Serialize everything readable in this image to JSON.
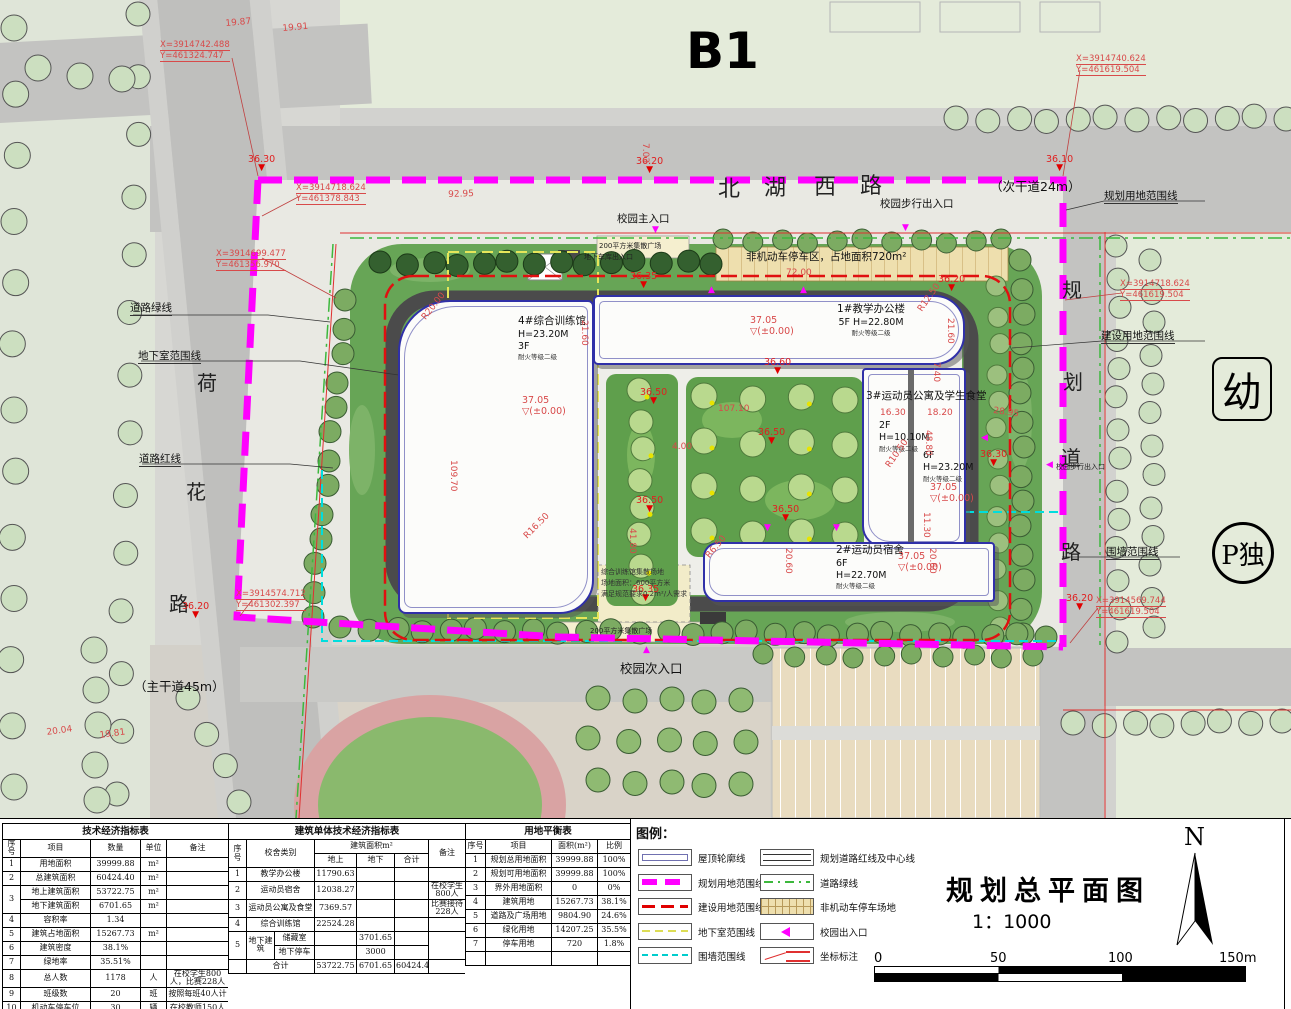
{
  "plan": {
    "zone_label": "B1",
    "markers": {
      "kindergarten": "幼",
      "parking_badge": "P独"
    },
    "buildings": {
      "b4": {
        "name": "4#综合训练馆",
        "height": "H=23.20M",
        "floors": "3F",
        "fire": "耐火等级二级"
      },
      "b1": {
        "name": "1#教学办公楼",
        "line2": "5F  H=22.80M",
        "fire": "耐火等级二级"
      },
      "b3": {
        "name": "3#运动员公寓及学生食堂",
        "west_floors": "2F",
        "west_height": "H=10.10M",
        "west_fire": "耐火等级二级",
        "east_floors": "6F",
        "east_height": "H=23.20M",
        "east_fire": "耐火等级二级"
      },
      "b2": {
        "name": "2#运动员宿舍",
        "floors": "6F",
        "height": "H=22.70M",
        "fire": "耐火等级二级"
      }
    },
    "annotations": [
      {
        "cls": "zone",
        "x": 686,
        "y": 22,
        "t": "B1"
      },
      {
        "cls": "roadname",
        "x": 718,
        "y": 171,
        "t": "北"
      },
      {
        "cls": "roadname",
        "x": 764,
        "y": 170,
        "t": "湖"
      },
      {
        "cls": "roadname",
        "x": 814,
        "y": 169,
        "t": "西"
      },
      {
        "cls": "roadname",
        "x": 860,
        "y": 168,
        "t": "路"
      },
      {
        "cls": "roadchar",
        "x": 197,
        "y": 367,
        "t": "荷"
      },
      {
        "cls": "roadchar",
        "x": 186,
        "y": 476,
        "t": "花"
      },
      {
        "cls": "roadchar",
        "x": 169,
        "y": 588,
        "t": "路"
      },
      {
        "cls": "roadchar",
        "x": 1062,
        "y": 274,
        "t": "规"
      },
      {
        "cls": "roadchar",
        "x": 1063,
        "y": 366,
        "t": "划"
      },
      {
        "cls": "roadchar",
        "x": 1061,
        "y": 442,
        "t": "道"
      },
      {
        "cls": "roadchar",
        "x": 1061,
        "y": 536,
        "t": "路"
      },
      {
        "cls": "lblM",
        "x": 990,
        "y": 176,
        "t": "（次干道24m）"
      },
      {
        "cls": "lblM",
        "x": 134,
        "y": 676,
        "t": "（主干道45m）"
      },
      {
        "cls": "coord",
        "x": 160,
        "y": 40,
        "lines": [
          "X=3914742.488",
          "Y=461324.747"
        ]
      },
      {
        "cls": "coord",
        "x": 296,
        "y": 183,
        "lines": [
          "X=3914718.624",
          "Y=461378.843"
        ]
      },
      {
        "cls": "coord",
        "x": 216,
        "y": 249,
        "lines": [
          "X=3914699.477",
          "Y=461356.970"
        ]
      },
      {
        "cls": "coord",
        "x": 1076,
        "y": 54,
        "lines": [
          "X=3914740.624",
          "Y=461619.504"
        ]
      },
      {
        "cls": "coord",
        "x": 1120,
        "y": 279,
        "lines": [
          "X=3914718.624",
          "Y=461619.504"
        ]
      },
      {
        "cls": "coord",
        "x": 1096,
        "y": 596,
        "lines": [
          "X=3914569.744",
          "Y=461619.504"
        ]
      },
      {
        "cls": "coord",
        "x": 236,
        "y": 589,
        "lines": [
          "X=3914574.712",
          "Y=461302.397"
        ]
      },
      {
        "cls": "elev",
        "x": 248,
        "y": 155,
        "t": "36.30"
      },
      {
        "cls": "elev",
        "x": 636,
        "y": 157,
        "t": "36.20"
      },
      {
        "cls": "elev",
        "x": 1046,
        "y": 155,
        "t": "36.10"
      },
      {
        "cls": "elev",
        "x": 630,
        "y": 272,
        "t": "36.35"
      },
      {
        "cls": "elev",
        "x": 938,
        "y": 275,
        "t": "36.20"
      },
      {
        "cls": "elev",
        "x": 764,
        "y": 358,
        "t": "36.60"
      },
      {
        "cls": "elev",
        "x": 640,
        "y": 388,
        "t": "36.50"
      },
      {
        "cls": "elev",
        "x": 758,
        "y": 428,
        "t": "36.50"
      },
      {
        "cls": "elev",
        "x": 636,
        "y": 496,
        "t": "36.50"
      },
      {
        "cls": "elev",
        "x": 980,
        "y": 450,
        "t": "36.30"
      },
      {
        "cls": "elev",
        "x": 772,
        "y": 505,
        "t": "36.50"
      },
      {
        "cls": "elev",
        "x": 632,
        "y": 585,
        "t": "36.35"
      },
      {
        "cls": "elev",
        "x": 182,
        "y": 602,
        "t": "36.20"
      },
      {
        "cls": "elev",
        "x": 1066,
        "y": 594,
        "t": "36.20"
      },
      {
        "cls": "spot",
        "x": 522,
        "y": 396,
        "lines": [
          "37.05",
          "(±0.00)"
        ]
      },
      {
        "cls": "spot",
        "x": 750,
        "y": 316,
        "lines": [
          "37.05",
          "(±0.00)"
        ]
      },
      {
        "cls": "spot",
        "x": 930,
        "y": 483,
        "lines": [
          "37.05",
          "(±0.00)"
        ]
      },
      {
        "cls": "spot",
        "x": 898,
        "y": 552,
        "lines": [
          "37.05",
          "(±0.00)"
        ]
      },
      {
        "cls": "dim",
        "x": 225,
        "y": 19,
        "t": "19.87",
        "rot": -5
      },
      {
        "cls": "dim",
        "x": 282,
        "y": 24,
        "t": "19.91",
        "rot": -5
      },
      {
        "cls": "dim",
        "x": 448,
        "y": 190,
        "t": "92.95",
        "rot": -2
      },
      {
        "cls": "dim",
        "x": 650,
        "y": 143,
        "t": "7.03",
        "rot": 90
      },
      {
        "cls": "dim",
        "x": 786,
        "y": 268,
        "t": "72.00"
      },
      {
        "cls": "dim",
        "x": 458,
        "y": 460,
        "t": "109.70",
        "rot": 90
      },
      {
        "cls": "dim",
        "x": 589,
        "y": 320,
        "t": "21.60",
        "rot": 90
      },
      {
        "cls": "dim",
        "x": 955,
        "y": 318,
        "t": "21.60",
        "rot": 90
      },
      {
        "cls": "dim",
        "x": 941,
        "y": 362,
        "t": "7.40",
        "rot": 90
      },
      {
        "cls": "dim",
        "x": 880,
        "y": 408,
        "t": "16.30"
      },
      {
        "cls": "dim",
        "x": 927,
        "y": 408,
        "t": "18.20"
      },
      {
        "cls": "dim",
        "x": 994,
        "y": 406,
        "t": "28.95",
        "rot": 8
      },
      {
        "cls": "dim",
        "x": 933,
        "y": 430,
        "t": "48.80",
        "rot": 90
      },
      {
        "cls": "dim",
        "x": 718,
        "y": 404,
        "t": "107.10"
      },
      {
        "cls": "dim",
        "x": 672,
        "y": 442,
        "t": "4.00"
      },
      {
        "cls": "dim",
        "x": 637,
        "y": 528,
        "t": "41.80",
        "rot": 90
      },
      {
        "cls": "dim",
        "x": 793,
        "y": 548,
        "t": "20.60",
        "rot": 90
      },
      {
        "cls": "dim",
        "x": 937,
        "y": 548,
        "t": "20.60",
        "rot": 90
      },
      {
        "cls": "dim",
        "x": 931,
        "y": 512,
        "t": "11.30",
        "rot": 90
      },
      {
        "cls": "dim",
        "x": 46,
        "y": 728,
        "t": "20.04",
        "rot": -8
      },
      {
        "cls": "dim",
        "x": 99,
        "y": 731,
        "t": "19.81",
        "rot": -8
      },
      {
        "cls": "dim",
        "x": 420,
        "y": 316,
        "t": "R20.00",
        "rot": -52
      },
      {
        "cls": "dim",
        "x": 916,
        "y": 308,
        "t": "R12.50",
        "rot": -55
      },
      {
        "cls": "dim",
        "x": 522,
        "y": 534,
        "t": "R16.50",
        "rot": -45
      },
      {
        "cls": "dim",
        "x": 884,
        "y": 464,
        "t": "R10.50",
        "rot": -55
      },
      {
        "cls": "dim",
        "x": 704,
        "y": 554,
        "t": "R6.50",
        "rot": -50
      },
      {
        "cls": "lbl",
        "x": 130,
        "y": 300,
        "t": "道路绿线",
        "ul": 1
      },
      {
        "cls": "lbl",
        "x": 138,
        "y": 348,
        "t": "地下室范围线",
        "ul": 1
      },
      {
        "cls": "lbl",
        "x": 139,
        "y": 451,
        "t": "道路红线",
        "ul": 1
      },
      {
        "cls": "lbl",
        "x": 1104,
        "y": 188,
        "t": "规划用地范围线",
        "ul": 1
      },
      {
        "cls": "lbl",
        "x": 1101,
        "y": 328,
        "t": "建设用地范围线",
        "ul": 1
      },
      {
        "cls": "lbl",
        "x": 1106,
        "y": 544,
        "t": "围墙范围线",
        "ul": 1
      },
      {
        "cls": "lbl",
        "x": 880,
        "y": 196,
        "t": "校园步行出入口"
      },
      {
        "cls": "lbl",
        "x": 617,
        "y": 211,
        "t": "校园主入口"
      },
      {
        "cls": "lblS",
        "x": 1056,
        "y": 462,
        "t": "校园步行出入口"
      },
      {
        "cls": "lblM",
        "x": 620,
        "y": 658,
        "t": "校园次入口"
      },
      {
        "cls": "lbl",
        "x": 746,
        "y": 249,
        "t": "非机动车停车区，占地面积720m²"
      },
      {
        "cls": "lblS",
        "x": 599,
        "y": 241,
        "t": "200平方米集散广场"
      },
      {
        "cls": "lblS",
        "x": 590,
        "y": 626,
        "t": "200平方米集散广场"
      },
      {
        "cls": "lblS",
        "x": 584,
        "y": 252,
        "t": "地下车库出入口"
      },
      {
        "cls": "lblT",
        "x": 601,
        "y": 567,
        "lines": [
          "综合训练馆集散场地",
          "场地面积：600平方米",
          "满足规范要求0.2m²/人需求"
        ]
      },
      {
        "cls": "entr",
        "x": 652,
        "y": 226,
        "t": "▼"
      },
      {
        "cls": "entr",
        "x": 902,
        "y": 224,
        "t": "▼"
      },
      {
        "cls": "entr",
        "x": 1046,
        "y": 461,
        "t": "◀"
      },
      {
        "cls": "entr",
        "x": 643,
        "y": 646,
        "t": "▲"
      },
      {
        "cls": "entr",
        "x": 708,
        "y": 286,
        "t": "▲"
      },
      {
        "cls": "entr",
        "x": 800,
        "y": 286,
        "t": "▲"
      },
      {
        "cls": "entr",
        "x": 764,
        "y": 524,
        "t": "▼"
      },
      {
        "cls": "entr",
        "x": 833,
        "y": 524,
        "t": "▼"
      },
      {
        "cls": "entr",
        "x": 981,
        "y": 434,
        "t": "◀"
      }
    ],
    "colors": {
      "boundary_magenta": "#FF00FF",
      "construction_red": "#E01010",
      "basement_yellow": "#E6E65A",
      "wall_cyan": "#00DDDD",
      "road_green_line": "#3DB83D",
      "annotation_red": "#D84A4A"
    }
  },
  "tables": {
    "tech": {
      "title": "技术经济指标表",
      "head": [
        [
          "序号",
          "项目",
          "数量",
          "单位",
          "备注"
        ]
      ],
      "rows": [
        [
          "1",
          "用地面积",
          "39999.88",
          "m²",
          ""
        ],
        [
          "2",
          "总建筑面积",
          "60424.40",
          "m²",
          ""
        ],
        [
          {
            "t": "3",
            "rs": 2
          },
          "地上建筑面积",
          "53722.75",
          "m²",
          ""
        ],
        [
          "地下建筑面积",
          "6701.65",
          "m²",
          ""
        ],
        [
          "4",
          "容积率",
          "1.34",
          "",
          ""
        ],
        [
          "5",
          "建筑占地面积",
          "15267.73",
          "m²",
          ""
        ],
        [
          "6",
          "建筑密度",
          "38.1%",
          "",
          ""
        ],
        [
          "7",
          "绿地率",
          "35.51%",
          "",
          ""
        ],
        [
          "8",
          "总人数",
          "1178",
          "人",
          "在校学生800人，比赛228人"
        ],
        [
          "9",
          "班级数",
          "20",
          "班",
          "按照每班40人计"
        ],
        [
          "10",
          "机动车停车位",
          "30",
          "辆",
          "在校教师150人"
        ],
        [
          "11",
          "非机动车停车位",
          "412",
          "辆",
          ""
        ]
      ]
    },
    "unit": {
      "title": "建筑单体技术经济指标表",
      "head": [
        [
          {
            "t": "序号",
            "rs": 2
          },
          {
            "t": "校舍类别",
            "cs": 2,
            "rs": 2
          },
          {
            "t": "建筑面积m²",
            "cs": 3
          },
          {
            "t": "备注",
            "rs": 2
          }
        ],
        [
          "地上",
          "地下",
          "合计"
        ]
      ],
      "rows": [
        [
          "1",
          {
            "t": "教学办公楼",
            "cs": 2
          },
          "11790.63",
          "",
          "",
          ""
        ],
        [
          "2",
          {
            "t": "运动员宿舍",
            "cs": 2
          },
          "12038.27",
          "",
          "",
          "在校学生800人"
        ],
        [
          "3",
          {
            "t": "运动员公寓及食堂",
            "cs": 2
          },
          "7369.57",
          "",
          "",
          "比赛接待228人"
        ],
        [
          "4",
          {
            "t": "综合训练馆",
            "cs": 2
          },
          "22524.28",
          "",
          "",
          ""
        ],
        [
          {
            "t": "5",
            "rs": 2
          },
          {
            "t": "地下建筑",
            "rs": 2
          },
          "储藏室",
          "",
          "3701.65",
          ""
        ],
        [
          "地下停车",
          "",
          "3000",
          ""
        ],
        [
          "",
          {
            "t": "合计",
            "cs": 2
          },
          "53722.75",
          "6701.65",
          "60424.40",
          ""
        ]
      ]
    },
    "balance": {
      "title": "用地平衡表",
      "head": [
        [
          "序号",
          "项目",
          "面积(m²)",
          "比例"
        ]
      ],
      "rows": [
        [
          "1",
          "规划总用地面积",
          "39999.88",
          "100%"
        ],
        [
          "2",
          "规划可用地面积",
          "39999.88",
          "100%"
        ],
        [
          "3",
          "界外用地面积",
          "0",
          "0%"
        ],
        [
          "4",
          "建筑用地",
          "15267.73",
          "38.1%"
        ],
        [
          "5",
          "道路及广场用地",
          "9804.90",
          "24.6%"
        ],
        [
          "6",
          "绿化用地",
          "14207.25",
          "35.5%"
        ],
        [
          "7",
          "停车用地",
          "720",
          "1.8%"
        ],
        [
          "",
          "",
          "",
          ""
        ]
      ]
    }
  },
  "legend": {
    "title": "图例：",
    "items": [
      {
        "label": "屋顶轮廓线",
        "swatch": "sw-roof"
      },
      {
        "label": "规划用地范围线",
        "swatch": "sw-mag"
      },
      {
        "label": "建设用地范围线",
        "swatch": "sw-red"
      },
      {
        "label": "地下室范围线",
        "swatch": "sw-yel"
      },
      {
        "label": "围墙范围线",
        "swatch": "sw-cyan"
      },
      {
        "label": "规划道路红线及中心线",
        "swatch": "sw-road"
      },
      {
        "label": "道路绿线",
        "swatch": "sw-green"
      },
      {
        "label": "非机动车停车场地",
        "swatch": "sw-park"
      },
      {
        "label": "校园出入口",
        "swatch": "sw-ent"
      },
      {
        "label": "坐标标注",
        "swatch": "sw-coord"
      }
    ]
  },
  "titleblock": {
    "title": "规划总平面图",
    "scale": "1：1000",
    "north_label": "N",
    "scalebar_ticks": [
      "0",
      "50",
      "100",
      "150m"
    ]
  }
}
